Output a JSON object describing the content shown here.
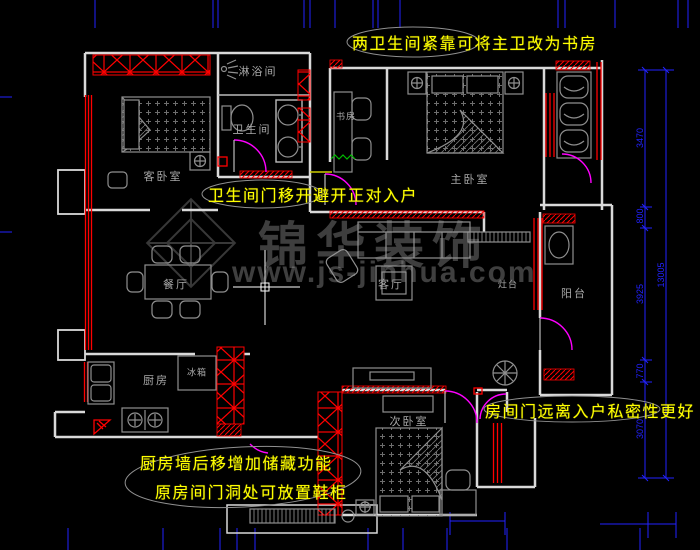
{
  "annotations": {
    "top": "两卫生间紧靠可将主卫改为书房",
    "hall": "卫生间门移开避开正对入户",
    "entry": "房间门远离入户私密性更好",
    "kitchen_line1": "厨房墙后移增加储藏功能",
    "kitchen_line2": "原房间门洞处可放置鞋柜"
  },
  "rooms": {
    "shower": "淋浴间",
    "bathroom": "卫生间",
    "guest_bedroom": "客卧室",
    "study": "书房",
    "master_bedroom": "主卧室",
    "dining": "餐厅",
    "living": "客厅",
    "counter": "灶台",
    "balcony": "阳台",
    "kitchen": "厨房",
    "fridge": "冰箱",
    "second_bedroom": "次卧室"
  },
  "dimensions": {
    "right": [
      "3470",
      "800",
      "3925",
      "770",
      "3070"
    ],
    "right_total": "13005"
  },
  "watermark": {
    "brand": "锦华装饰",
    "url": "www.js-jinhua.com"
  },
  "colors": {
    "wall": "#d9d9d9",
    "furniture": "#8f8f8f",
    "red": "#ff0000",
    "blue": "#2222ff",
    "yellow": "#ffff00",
    "magenta": "#ff00ff",
    "annotation_ellipse": "#909090",
    "background": "#000000"
  }
}
